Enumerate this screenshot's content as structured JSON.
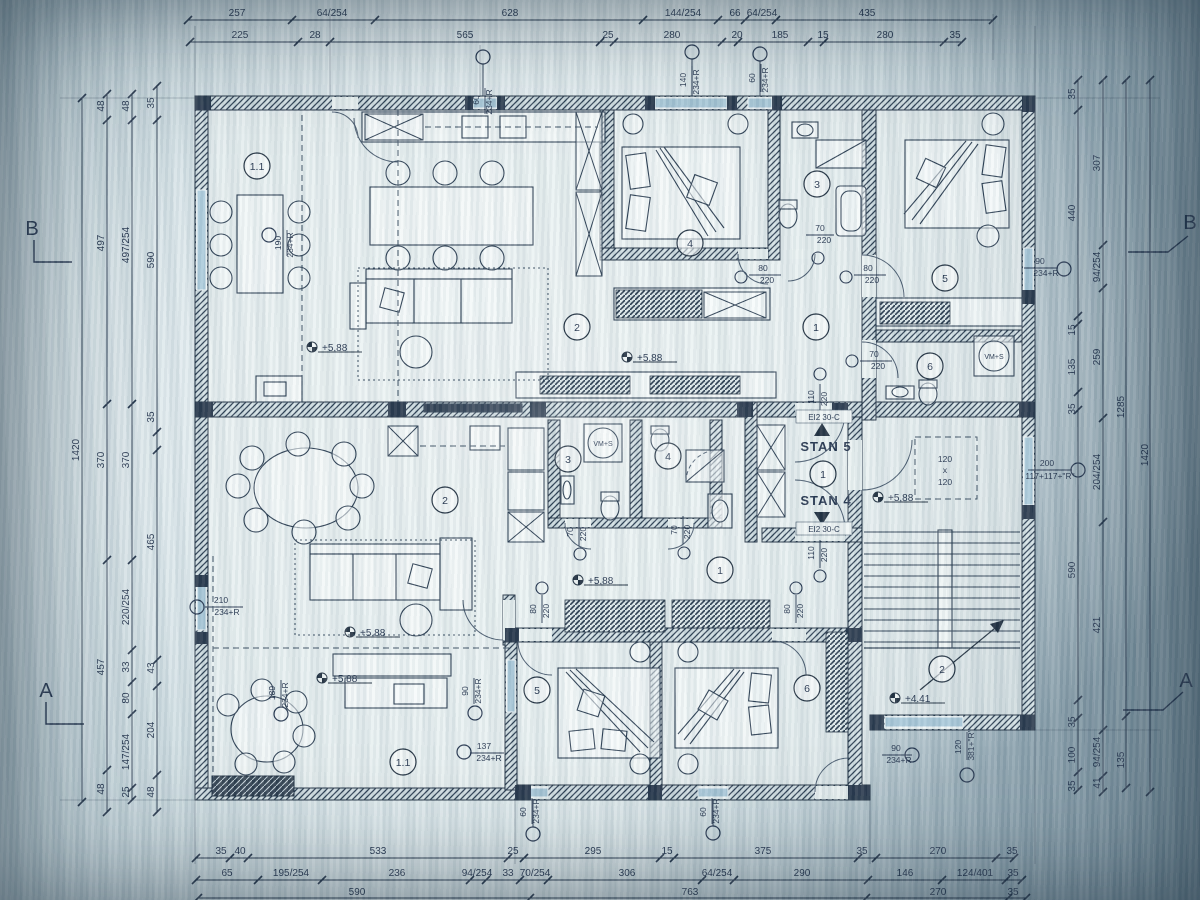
{
  "sheet": {
    "type": "architectural floor plan photo",
    "paper_color": "#dfe9ec",
    "ink_color": "#1d2c3c",
    "glazing_color": "#a9c9db"
  },
  "apartments": {
    "stan5": "STAN 5",
    "stan4": "STAN 4"
  },
  "sections": {
    "a": "A",
    "b": "B"
  },
  "rooms": {
    "n1": "1",
    "n11": "1.1",
    "n2": "2",
    "n3": "3",
    "n4": "4",
    "n5": "5",
    "n6": "6"
  },
  "fire_door": "EI2 30-C",
  "elevations": {
    "upper": "+5,88",
    "stair": "+4.41"
  },
  "shaft": {
    "w": "120",
    "sep": "x",
    "h": "120"
  },
  "appliance": {
    "washer": "VM+S"
  },
  "openings": {
    "d70": {
      "w": "70",
      "h": "220"
    },
    "d80": {
      "w": "80",
      "h": "220"
    },
    "d110": {
      "w": "110",
      "h": "220"
    },
    "w60": {
      "w": "60",
      "h": "234+R"
    },
    "w90": {
      "w": "90",
      "h": "234+R"
    },
    "w120": {
      "w": "120",
      "h": "381+\"R\""
    },
    "w137": {
      "w": "137",
      "h": "234+R"
    },
    "w140": {
      "w": "140",
      "h": "234+R"
    },
    "w189": {
      "w": "189",
      "h": "234+R"
    },
    "w190": {
      "w": "190",
      "h": "234+R"
    },
    "w200": {
      "w": "200",
      "h": "117+117+\"R\""
    },
    "w210": {
      "w": "210",
      "h": "234+R"
    }
  },
  "dims": {
    "top1": [
      "257",
      "64/254",
      "628",
      "144/254",
      "66",
      "64/254",
      "435"
    ],
    "top2": [
      "225",
      "28",
      "565",
      "25",
      "280",
      "20",
      "185",
      "15",
      "280",
      "35"
    ],
    "bottom1": [
      "35",
      "40",
      "533",
      "25",
      "295",
      "15",
      "375",
      "35",
      "270",
      "35"
    ],
    "bottom2": [
      "65",
      "195/254",
      "236",
      "94/254",
      "33",
      "70/254",
      "306",
      "64/254",
      "290",
      "146",
      "124/401",
      "35"
    ],
    "bottom3": [
      "590",
      "763",
      "270",
      "35"
    ],
    "left1": [
      "1420"
    ],
    "left2": [
      "48",
      "497",
      "370",
      "457",
      "48"
    ],
    "left3": [
      "48",
      "497/254",
      "370",
      "220/254",
      "33",
      "80",
      "147/254",
      "25"
    ],
    "left4": [
      "35",
      "590",
      "35",
      "465",
      "43",
      "204",
      "48"
    ],
    "right1": [
      "35",
      "440",
      "15",
      "135",
      "35",
      "590",
      "35",
      "100",
      "35"
    ],
    "right2": [
      "307",
      "94/254",
      "259",
      "204/254",
      "421",
      "94/254",
      "41"
    ],
    "right3": [
      "1285",
      "135"
    ],
    "right4": [
      "1420"
    ]
  }
}
